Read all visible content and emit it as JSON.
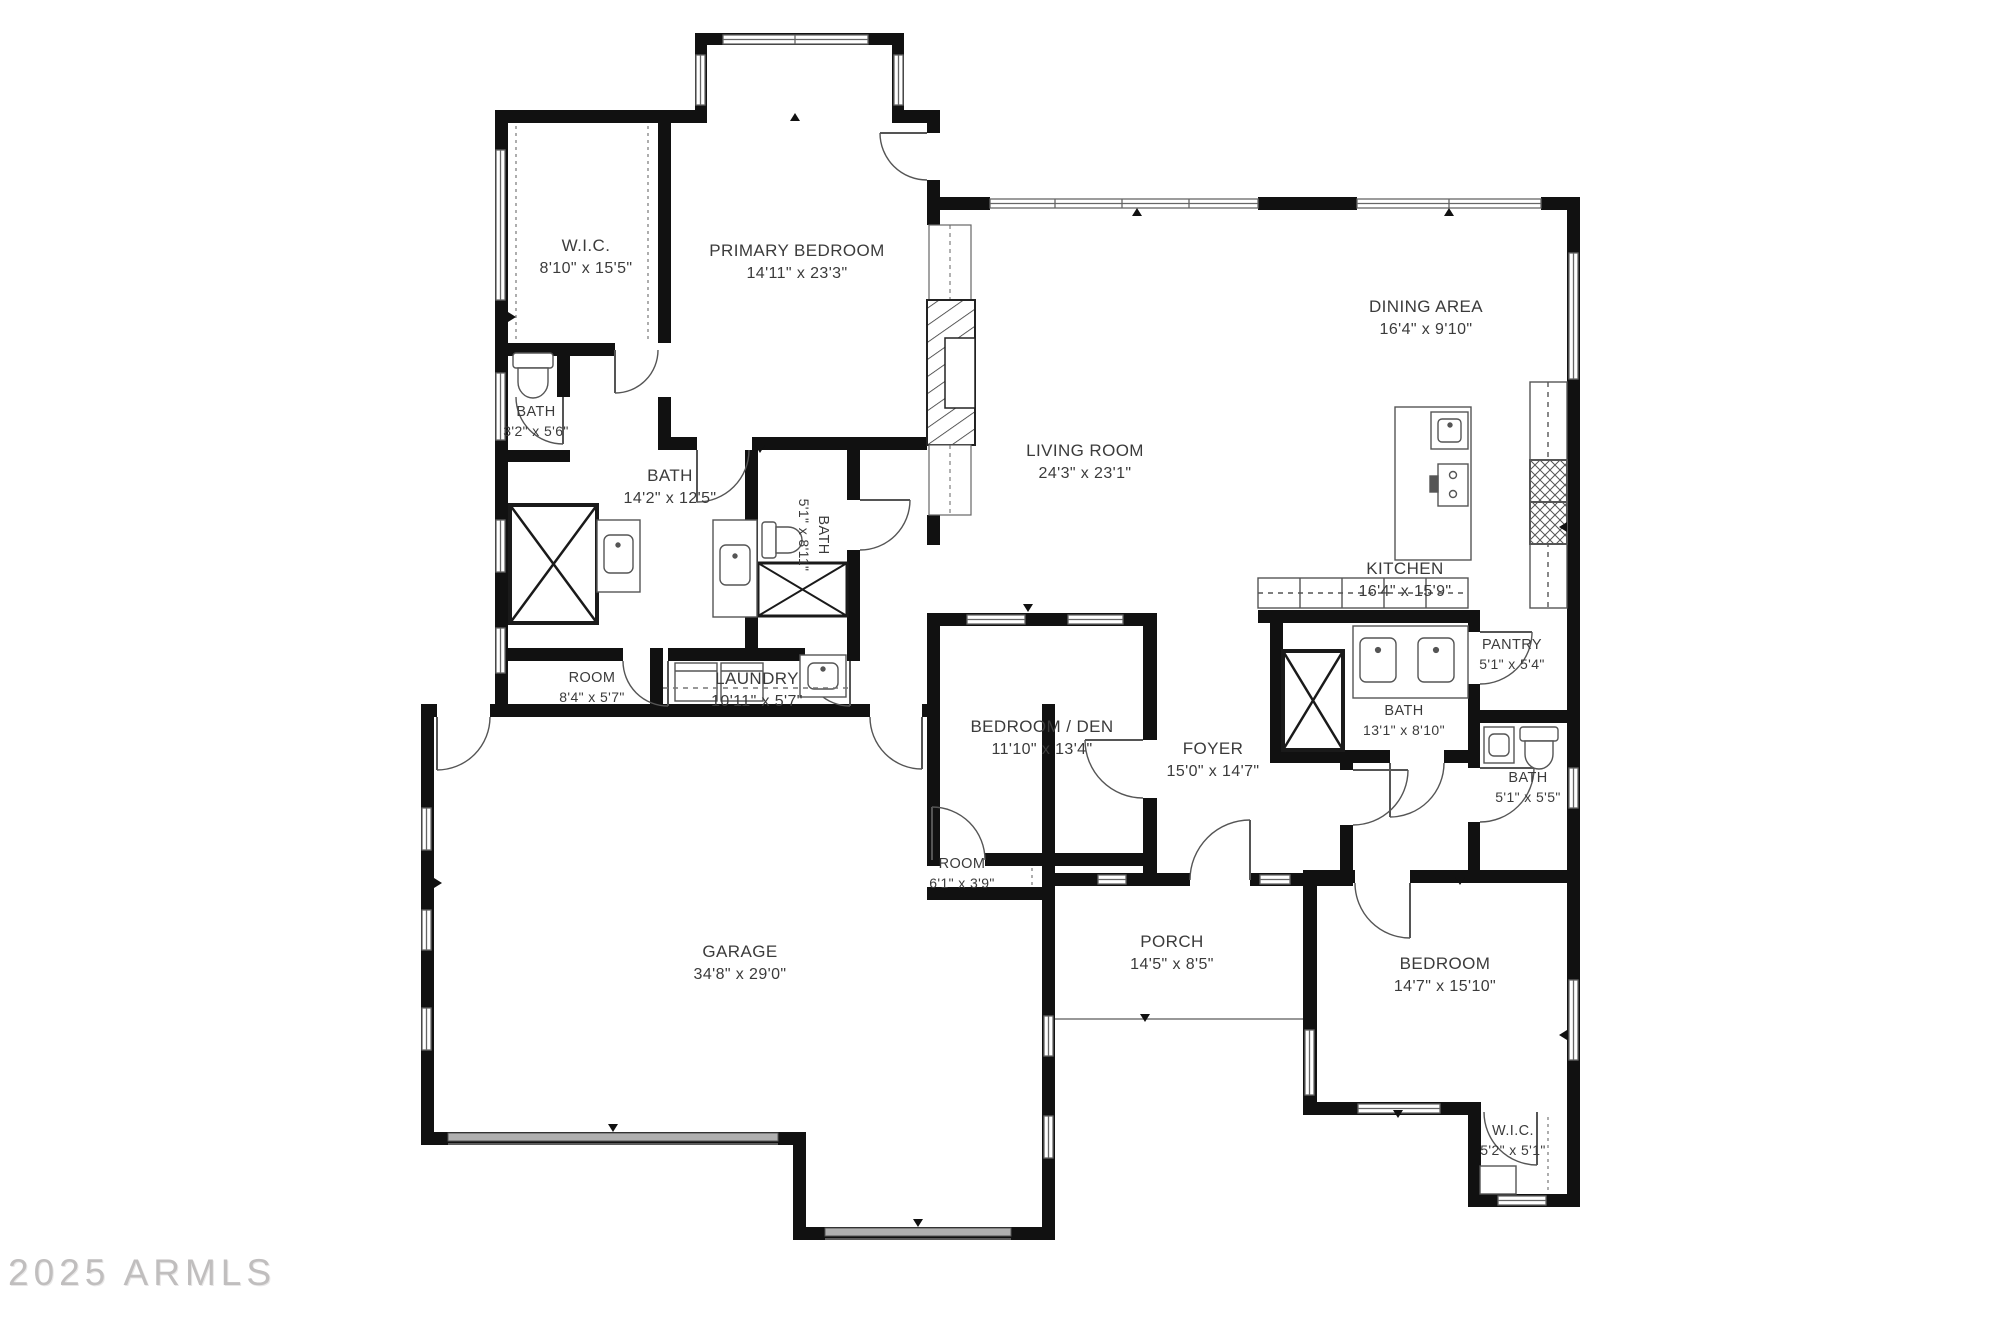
{
  "watermark": "2025 ARMLS",
  "plan": {
    "wall_color": "#111111",
    "line_color": "#555555",
    "label_color": "#3b3b3b",
    "garage_door_color": "#b0b0b0"
  },
  "rooms": [
    {
      "id": "wic-primary",
      "name": "W.I.C.",
      "dims": "8'10\" x 15'5\"",
      "x": 586,
      "y": 257,
      "small": false,
      "rot": 0
    },
    {
      "id": "primary-bedroom",
      "name": "PRIMARY BEDROOM",
      "dims": "14'11\" x 23'3\"",
      "x": 797,
      "y": 262,
      "small": false,
      "rot": 0
    },
    {
      "id": "bath-3-2",
      "name": "BATH",
      "dims": "3'2\" x 5'6\"",
      "x": 536,
      "y": 422,
      "small": true,
      "rot": 0
    },
    {
      "id": "bath-14-2",
      "name": "BATH",
      "dims": "14'2\" x 12'5\"",
      "x": 670,
      "y": 487,
      "small": false,
      "rot": 0
    },
    {
      "id": "bath-5-1-8-11",
      "name": "BATH",
      "dims": "5'1\" x 8'11\"",
      "x": 813,
      "y": 535,
      "small": true,
      "rot": 90
    },
    {
      "id": "room-8-4",
      "name": "ROOM",
      "dims": "8'4\" x 5'7\"",
      "x": 592,
      "y": 688,
      "small": true,
      "rot": 0
    },
    {
      "id": "laundry",
      "name": "LAUNDRY",
      "dims": "10'11\" x 5'7\"",
      "x": 757,
      "y": 690,
      "small": false,
      "rot": 0
    },
    {
      "id": "living-room",
      "name": "LIVING ROOM",
      "dims": "24'3\" x 23'1\"",
      "x": 1085,
      "y": 462,
      "small": false,
      "rot": 0
    },
    {
      "id": "dining-area",
      "name": "DINING AREA",
      "dims": "16'4\" x 9'10\"",
      "x": 1426,
      "y": 318,
      "small": false,
      "rot": 0
    },
    {
      "id": "kitchen",
      "name": "KITCHEN",
      "dims": "16'4\" x 15'9\"",
      "x": 1405,
      "y": 580,
      "small": false,
      "rot": 0
    },
    {
      "id": "pantry",
      "name": "PANTRY",
      "dims": "5'1\" x 5'4\"",
      "x": 1512,
      "y": 655,
      "small": true,
      "rot": 0
    },
    {
      "id": "bath-13-1",
      "name": "BATH",
      "dims": "13'1\" x 8'10\"",
      "x": 1404,
      "y": 721,
      "small": true,
      "rot": 0
    },
    {
      "id": "bath-5-1-5-5",
      "name": "BATH",
      "dims": "5'1\" x 5'5\"",
      "x": 1528,
      "y": 788,
      "small": true,
      "rot": 0
    },
    {
      "id": "bedroom-den",
      "name": "BEDROOM / DEN",
      "dims": "11'10\" x 13'4\"",
      "x": 1042,
      "y": 738,
      "small": false,
      "rot": 0
    },
    {
      "id": "foyer",
      "name": "FOYER",
      "dims": "15'0\" x 14'7\"",
      "x": 1213,
      "y": 760,
      "small": false,
      "rot": 0
    },
    {
      "id": "room-6-1",
      "name": "ROOM",
      "dims": "6'1\" x 3'9\"",
      "x": 962,
      "y": 874,
      "small": true,
      "rot": 0
    },
    {
      "id": "garage",
      "name": "GARAGE",
      "dims": "34'8\" x 29'0\"",
      "x": 740,
      "y": 963,
      "small": false,
      "rot": 0
    },
    {
      "id": "porch",
      "name": "PORCH",
      "dims": "14'5\" x 8'5\"",
      "x": 1172,
      "y": 953,
      "small": false,
      "rot": 0
    },
    {
      "id": "bedroom",
      "name": "BEDROOM",
      "dims": "14'7\" x 15'10\"",
      "x": 1445,
      "y": 975,
      "small": false,
      "rot": 0
    },
    {
      "id": "wic-bedroom",
      "name": "W.I.C.",
      "dims": "5'2\" x 5'1\"",
      "x": 1513,
      "y": 1141,
      "small": true,
      "rot": 0
    }
  ]
}
